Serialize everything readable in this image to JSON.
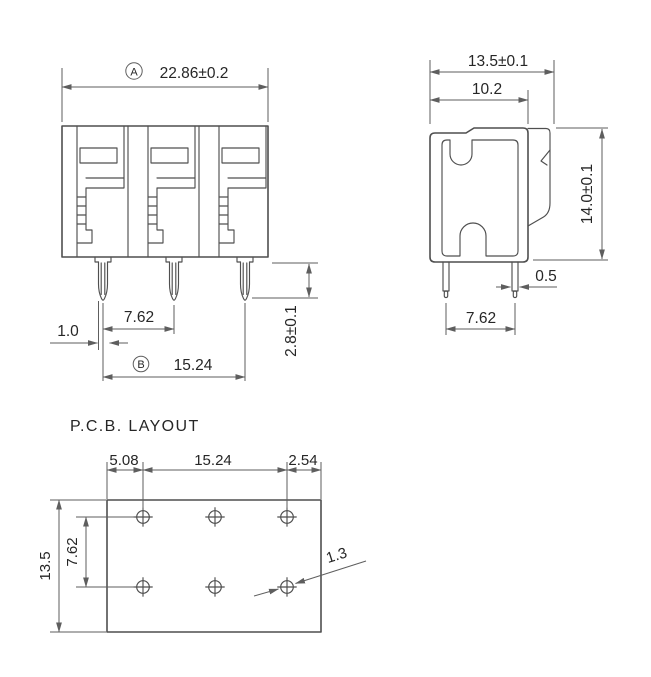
{
  "drawing": {
    "background": "#ffffff",
    "line_color": "#4f4f4f",
    "dim_color": "#5e5e5e",
    "text_color": "#262626",
    "front_view": {
      "datum_a": "A",
      "dim_total_width": "22.86±0.2",
      "dim_pin_pitch": "7.62",
      "dim_pin_thickness": "1.0",
      "datum_b": "B",
      "dim_outer_pin_span": "15.24",
      "dim_pin_protrusion": "2.8±0.1"
    },
    "side_view": {
      "dim_total_depth": "13.5±0.1",
      "dim_body_depth": "10.2",
      "dim_total_height": "14.0±0.1",
      "dim_pin_width": "0.5",
      "dim_pin_pitch": "7.62"
    },
    "pcb_layout": {
      "title": "P.C.B. LAYOUT",
      "dim_edge_to_hole": "5.08",
      "dim_hole_span": "15.24",
      "dim_hole_to_edge": "2.54",
      "dim_board_height": "13.5",
      "dim_row_pitch": "7.62",
      "dim_hole_diameter": "1.3"
    }
  }
}
